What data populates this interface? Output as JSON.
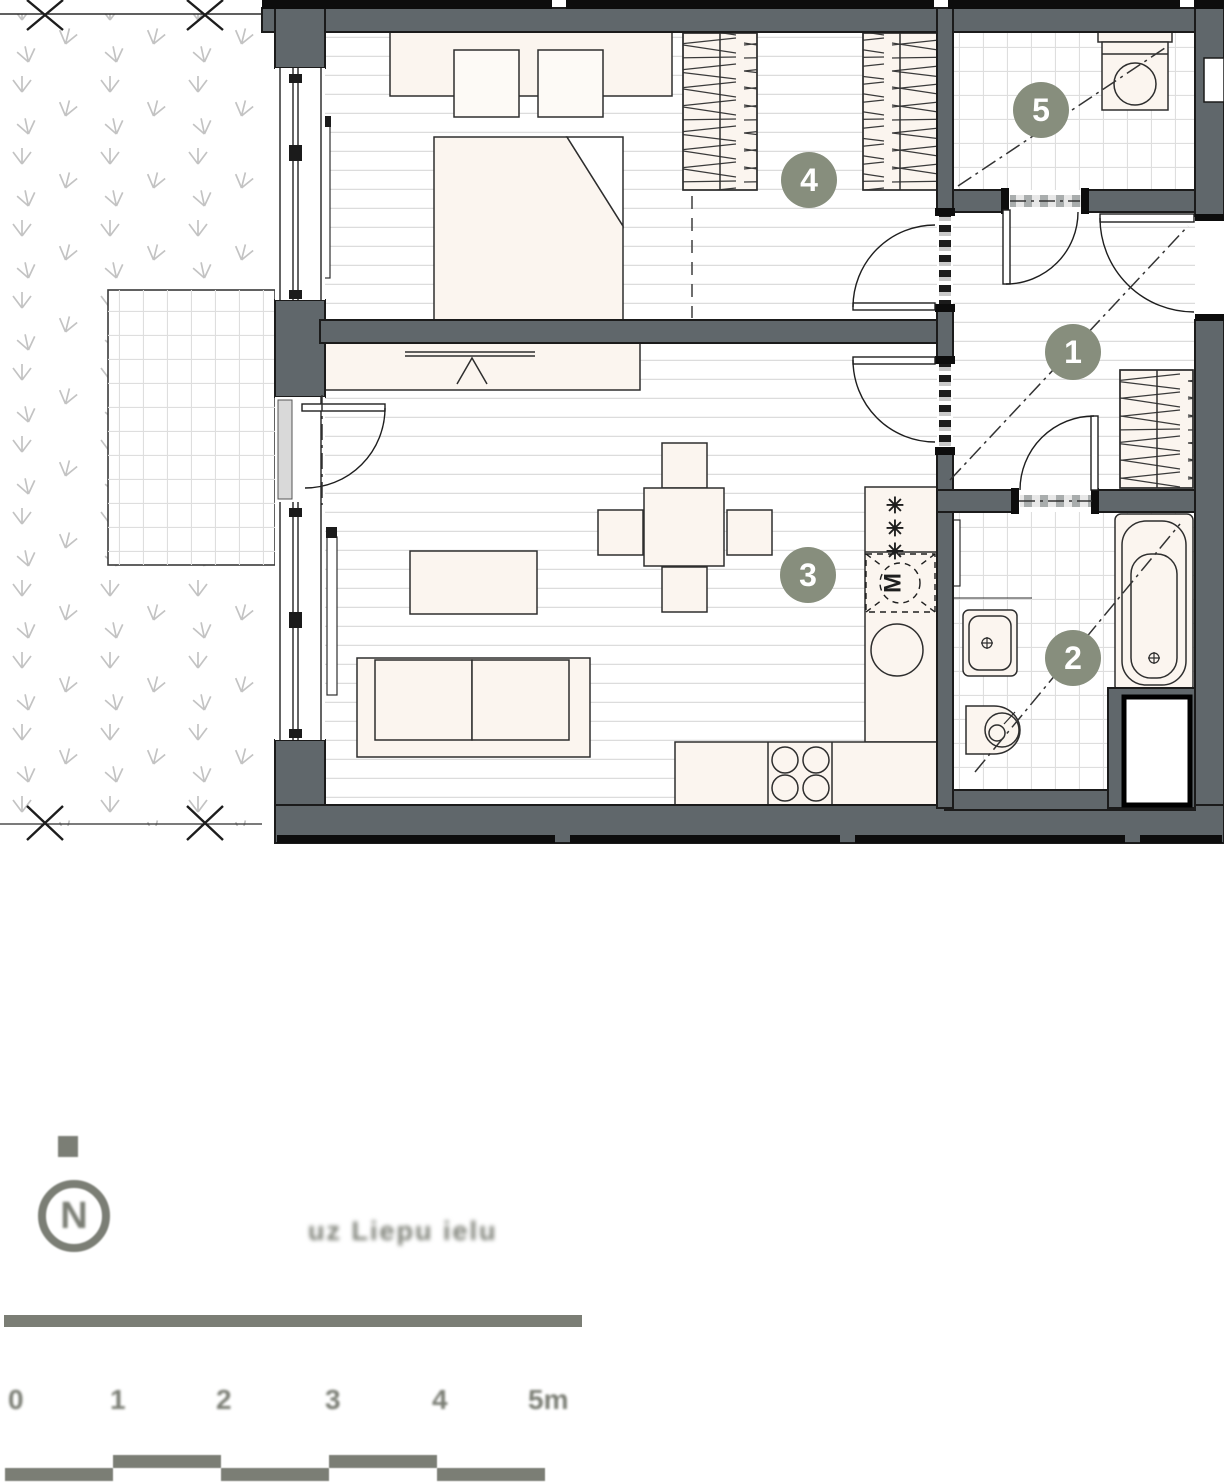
{
  "plan": {
    "room_badges": [
      {
        "number": "1"
      },
      {
        "number": "2"
      },
      {
        "number": "3"
      },
      {
        "number": "4"
      },
      {
        "number": "5"
      }
    ],
    "kitchen": {
      "freezer_symbol": "✳",
      "appliance_letter": "M"
    }
  },
  "footer": {
    "compass_letter": "N",
    "caption": "uz Liepu ielu",
    "scale_labels": [
      "0",
      "1",
      "2",
      "3",
      "4",
      "5m"
    ]
  },
  "colors": {
    "wall": "#60676b",
    "badge": "#878e7d",
    "accent_gray": "#7b7e75",
    "furniture": "#fbf5ef"
  }
}
